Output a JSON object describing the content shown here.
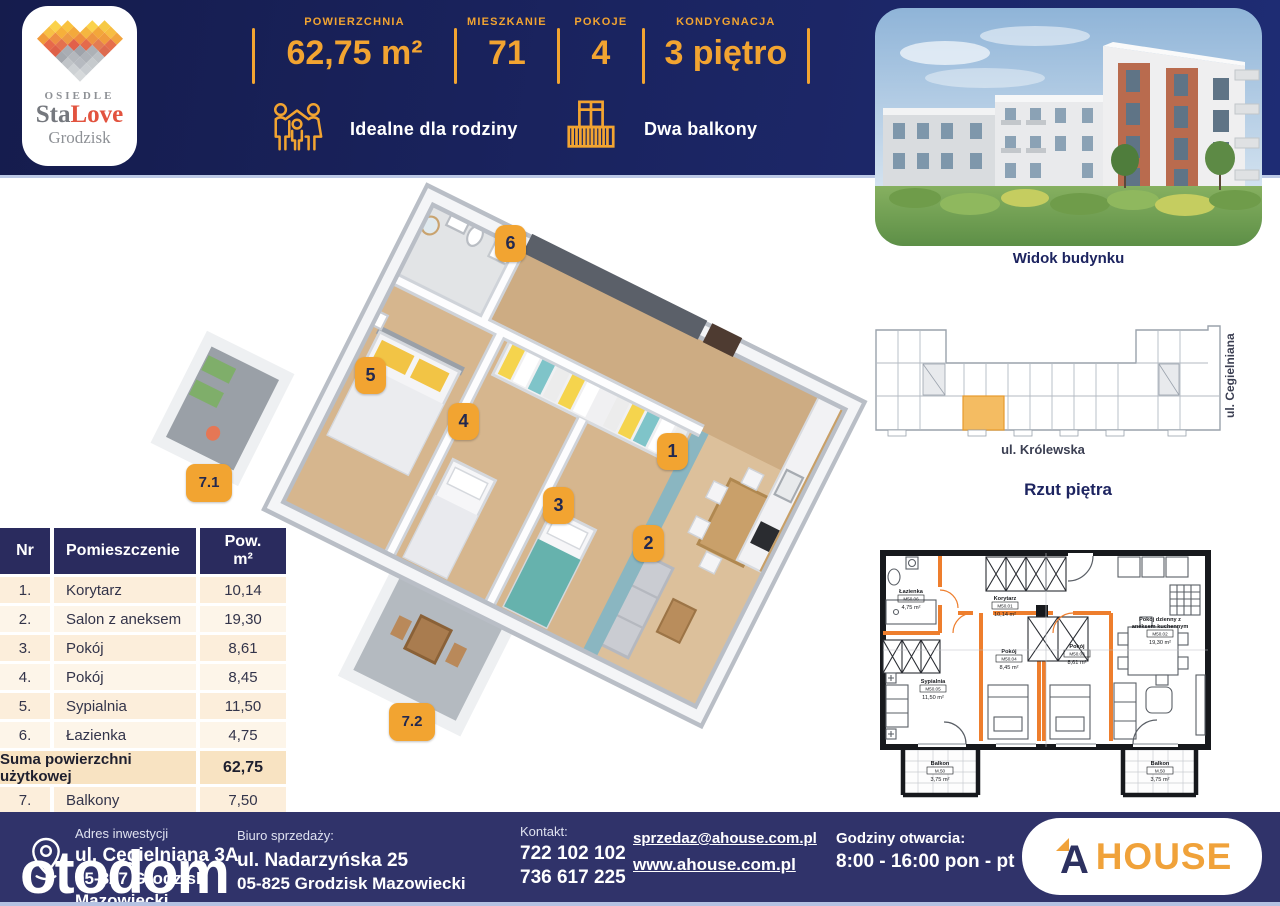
{
  "colors": {
    "header_navy": "#1b2563",
    "footer_navy": "#30336a",
    "accent_orange": "#f2a431",
    "logo_red": "#e2533f",
    "table_header_navy": "#2a2b5e",
    "table_row_cream": "#fceedb",
    "table_sum_cream": "#f8e3c2",
    "light_divider": "#bcc9e6",
    "plan_wall_orange": "#ee7e2d",
    "teal_accent_wall": "#8ab6c1",
    "wood_floor": "#d3b28a"
  },
  "logo": {
    "top": "OSIEDLE",
    "brand_gray": "Sta",
    "brand_accent": "Love",
    "bottom": "Grodzisk"
  },
  "header": {
    "stats": [
      {
        "label": "POWIERZCHNIA",
        "value": "62,75 m²"
      },
      {
        "label": "MIESZKANIE",
        "value": "71"
      },
      {
        "label": "POKOJE",
        "value": "4"
      },
      {
        "label": "KONDYGNACJA",
        "value": "3 piętro"
      }
    ],
    "features": [
      {
        "icon": "family-icon",
        "label": "Idealne dla rodziny"
      },
      {
        "icon": "balcony-icon",
        "label": "Dwa balkony"
      }
    ]
  },
  "building_photo": {
    "caption": "Widok budynku"
  },
  "site_plan": {
    "street_bottom": "ul. Królewska",
    "street_right": "ul. Cegielniana",
    "caption": "Rzut piętra"
  },
  "rooms_table": {
    "headers": {
      "nr": "Nr",
      "name": "Pomieszczenie",
      "area1": "Pow.",
      "area2": "m²"
    },
    "rows": [
      {
        "nr": "1.",
        "name": "Korytarz",
        "area": "10,14"
      },
      {
        "nr": "2.",
        "name": "Salon z aneksem",
        "area": "19,30"
      },
      {
        "nr": "3.",
        "name": "Pokój",
        "area": "8,61"
      },
      {
        "nr": "4.",
        "name": "Pokój",
        "area": "8,45"
      },
      {
        "nr": "5.",
        "name": "Sypialnia",
        "area": "11,50"
      },
      {
        "nr": "6.",
        "name": "Łazienka",
        "area": "4,75"
      }
    ],
    "summary": {
      "label": "Suma powierzchni użytkowej",
      "value": "62,75"
    },
    "extra_row": {
      "nr": "7.",
      "name": "Balkony",
      "area": "7,50"
    }
  },
  "plan3d": {
    "markers": [
      {
        "label": "1"
      },
      {
        "label": "2"
      },
      {
        "label": "3"
      },
      {
        "label": "4"
      },
      {
        "label": "5"
      },
      {
        "label": "6"
      },
      {
        "label": "7.1"
      },
      {
        "label": "7.2"
      }
    ]
  },
  "plan2d": {
    "rooms": [
      {
        "name": "Łazienka",
        "id": "M50.06",
        "area": "4,75 m²"
      },
      {
        "name": "Korytarz",
        "id": "M50.01",
        "area": "10,14 m²"
      },
      {
        "name": "Sypialnia",
        "id": "M50.05",
        "area": "11,50 m²"
      },
      {
        "name": "Pokój",
        "id": "M50.04",
        "area": "8,45 m²"
      },
      {
        "name": "Pokój",
        "id": "M50.03",
        "area": "8,61 m²"
      },
      {
        "name": "Pokój dzienny z",
        "name2": "aneksem kuchennym",
        "id": "M50.02",
        "area": "19,30 m²"
      },
      {
        "name": "Balkon",
        "id": "M.50",
        "area": "3,75 m²"
      },
      {
        "name": "Balkon",
        "id": "M.50",
        "area": "3,75 m²"
      }
    ]
  },
  "footer": {
    "address": {
      "label": "Adres inwestycji",
      "street": "ul. Cegielniana 3A",
      "city1": "05-827 Grodzisk",
      "city2": "Mazowiecki"
    },
    "sales_office": {
      "label": "Biuro sprzedaży:",
      "street": "ul. Nadarzyńska 25",
      "city": "05-825 Grodzisk Mazowiecki"
    },
    "contact": {
      "label": "Kontakt:",
      "phone1": "722 102 102",
      "phone2": "736 617 225"
    },
    "links": {
      "email": "sprzedaz@ahouse.com.pl",
      "website": "www.ahouse.com.pl"
    },
    "hours": {
      "label": "Godziny otwarcia:",
      "value": "8:00 - 16:00 pon - pt"
    },
    "brand": {
      "a": "A",
      "rest": "HOUSE"
    }
  },
  "watermark": "otodom"
}
